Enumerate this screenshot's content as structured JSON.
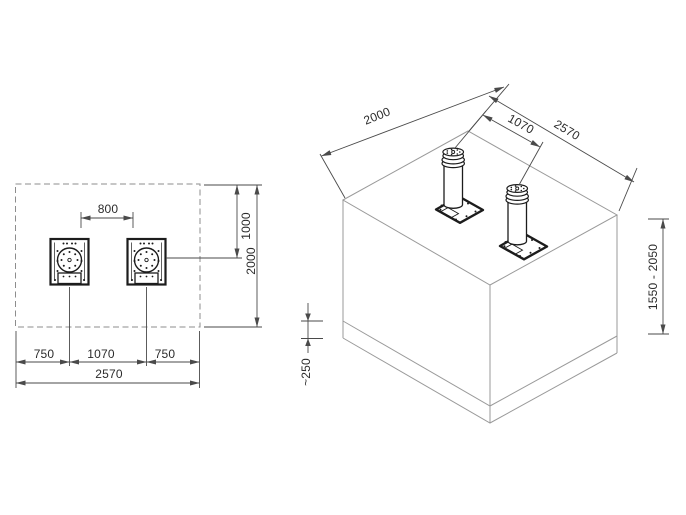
{
  "colors": {
    "bg": "#ffffff",
    "line": "#9a9a9a",
    "dim": "#4a4a4a",
    "dark": "#1c1c1c",
    "dash": "#8d8d8d",
    "text": "#2b2b2b"
  },
  "plan_view": {
    "dim_bollard_gap": "800",
    "dim_edge_to_axis": "1000",
    "dim_pit_depth": "2000",
    "dim_left_margin": "750",
    "dim_axis_spacing": "1070",
    "dim_right_margin": "750",
    "dim_pit_width": "2570"
  },
  "iso_view": {
    "dim_pit_depth": "2000",
    "dim_axis_spacing": "1070",
    "dim_pit_width": "2570",
    "dim_pit_height_range": "1550 - 2050",
    "dim_base_layer": "~250"
  }
}
